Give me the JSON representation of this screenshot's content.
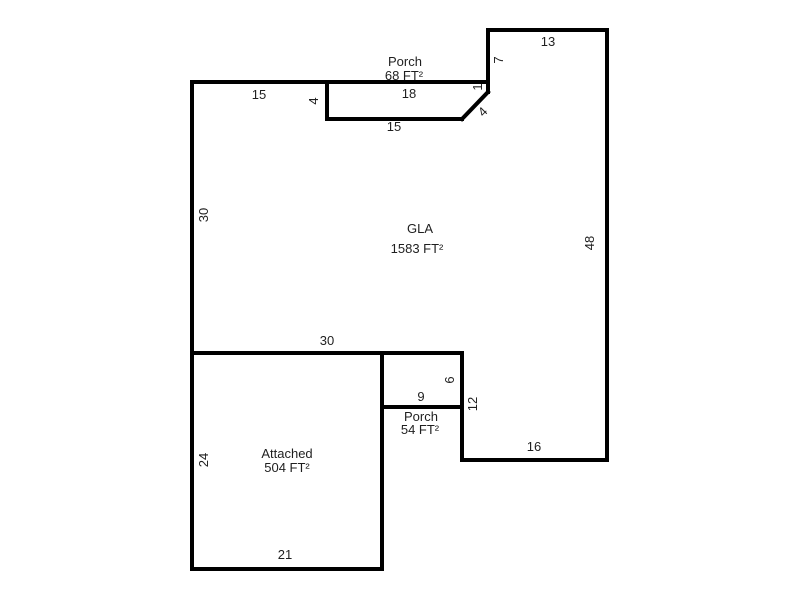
{
  "diagram": {
    "type": "floorplan-sketch",
    "background_color": "#ffffff",
    "line_color": "#000000",
    "text_color": "#1f1f1f",
    "stroke_width": 4,
    "regions": [
      {
        "id": "porch-top",
        "label": "Porch",
        "area": "68 FT²",
        "label_x": 405,
        "label_y": 62,
        "area_x": 404,
        "area_y": 76
      },
      {
        "id": "gla",
        "label": "GLA",
        "area": "1583 FT²",
        "label_x": 420,
        "label_y": 229,
        "area_x": 417,
        "area_y": 249
      },
      {
        "id": "porch-middle",
        "label": "Porch",
        "area": "54 FT²",
        "label_x": 421,
        "label_y": 417,
        "area_x": 420,
        "area_y": 430
      },
      {
        "id": "attached",
        "label": "Attached",
        "area": "504 FT²",
        "label_x": 287,
        "label_y": 454,
        "area_x": 287,
        "area_y": 468
      }
    ],
    "walls": [
      {
        "name": "top-wall",
        "x1": 192,
        "y1": 82,
        "x2": 488,
        "y2": 82
      },
      {
        "name": "left-wall",
        "x1": 192,
        "y1": 82,
        "x2": 192,
        "y2": 569
      },
      {
        "name": "porch-top-left-wall",
        "x1": 327,
        "y1": 82,
        "x2": 327,
        "y2": 119
      },
      {
        "name": "porch-top-bottom-wall",
        "x1": 327,
        "y1": 119,
        "x2": 462,
        "y2": 119
      },
      {
        "name": "porch-diagonal-wall",
        "x1": 462,
        "y1": 119,
        "x2": 488,
        "y2": 92
      },
      {
        "name": "notch-left-wall",
        "x1": 488,
        "y1": 30,
        "x2": 488,
        "y2": 92
      },
      {
        "name": "upper-right-top-wall",
        "x1": 488,
        "y1": 30,
        "x2": 607,
        "y2": 30
      },
      {
        "name": "right-wall",
        "x1": 607,
        "y1": 30,
        "x2": 607,
        "y2": 460
      },
      {
        "name": "bottom-right-wall",
        "x1": 462,
        "y1": 460,
        "x2": 607,
        "y2": 460
      },
      {
        "name": "mid-right-wall",
        "x1": 462,
        "y1": 353,
        "x2": 462,
        "y2": 460
      },
      {
        "name": "mid-horizontal-wall",
        "x1": 192,
        "y1": 353,
        "x2": 462,
        "y2": 353
      },
      {
        "name": "porch-middle-bottom-wall",
        "x1": 382,
        "y1": 407,
        "x2": 462,
        "y2": 407
      },
      {
        "name": "attached-right-wall",
        "x1": 382,
        "y1": 353,
        "x2": 382,
        "y2": 569
      },
      {
        "name": "attached-bottom-wall",
        "x1": 192,
        "y1": 569,
        "x2": 382,
        "y2": 569
      }
    ],
    "dimensions": [
      {
        "text": "15",
        "x": 259,
        "y": 95,
        "rot": 0
      },
      {
        "text": "4",
        "x": 314,
        "y": 101,
        "rot": -90
      },
      {
        "text": "18",
        "x": 409,
        "y": 94,
        "rot": 0
      },
      {
        "text": "15",
        "x": 394,
        "y": 127,
        "rot": 0
      },
      {
        "text": "1",
        "x": 478,
        "y": 87,
        "rot": -90
      },
      {
        "text": "4",
        "x": 483,
        "y": 112,
        "rot": -45
      },
      {
        "text": "7",
        "x": 499,
        "y": 60,
        "rot": -90
      },
      {
        "text": "13",
        "x": 548,
        "y": 42,
        "rot": 0
      },
      {
        "text": "48",
        "x": 590,
        "y": 243,
        "rot": -90
      },
      {
        "text": "30",
        "x": 204,
        "y": 215,
        "rot": -90
      },
      {
        "text": "30",
        "x": 327,
        "y": 341,
        "rot": 0
      },
      {
        "text": "6",
        "x": 450,
        "y": 380,
        "rot": -90
      },
      {
        "text": "9",
        "x": 421,
        "y": 397,
        "rot": 0
      },
      {
        "text": "12",
        "x": 473,
        "y": 404,
        "rot": -90
      },
      {
        "text": "16",
        "x": 534,
        "y": 447,
        "rot": 0
      },
      {
        "text": "24",
        "x": 204,
        "y": 460,
        "rot": -90
      },
      {
        "text": "21",
        "x": 285,
        "y": 555,
        "rot": 0
      }
    ]
  }
}
